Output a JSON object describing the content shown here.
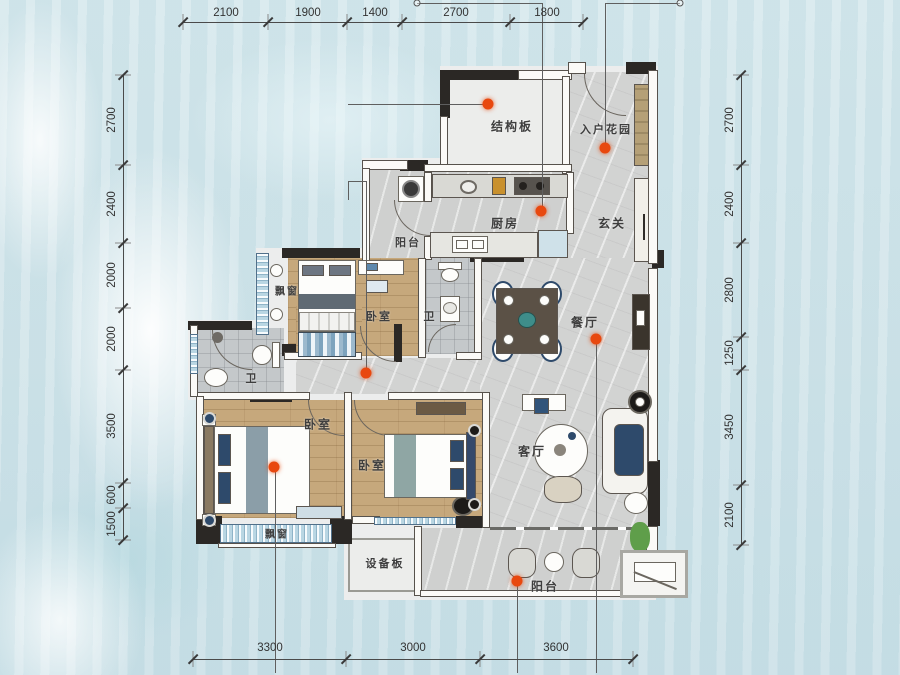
{
  "plan": {
    "type": "apartment-floor-plan",
    "rooms": {
      "structural_slab": "结构板",
      "entry_garden": "入户花园",
      "kitchen": "厨房",
      "service_balcony": "阳台",
      "foyer": "玄关",
      "bay_window_top": "飘窗",
      "bedroom_top": "卧室",
      "bath_top": "卫",
      "bath_left": "卫",
      "dining_room": "餐厅",
      "bedroom_left": "卧室",
      "bedroom_mid": "卧室",
      "living_room": "客厅",
      "bay_window_bottom": "飘窗",
      "equipment_board": "设备板",
      "balcony_bottom": "阳台"
    },
    "dimensions_mm": {
      "top": [
        "2100",
        "1900",
        "1400",
        "2700",
        "1800"
      ],
      "left": [
        "2700",
        "2400",
        "2000",
        "2000",
        "3500",
        "600",
        "1500"
      ],
      "right": [
        "2700",
        "2400",
        "2800",
        "1250",
        "3450",
        "2100"
      ],
      "bottom": [
        "3300",
        "3000",
        "3600"
      ]
    },
    "colors": {
      "background": "#cfe3e9",
      "wall_dark": "#2b2825",
      "wood_floor": "#c6a87c",
      "marble_floor": "#d2d3d2",
      "marker_dot": "#e8480f",
      "window_blue": "#b9d6e3"
    },
    "marker_count": "7"
  }
}
